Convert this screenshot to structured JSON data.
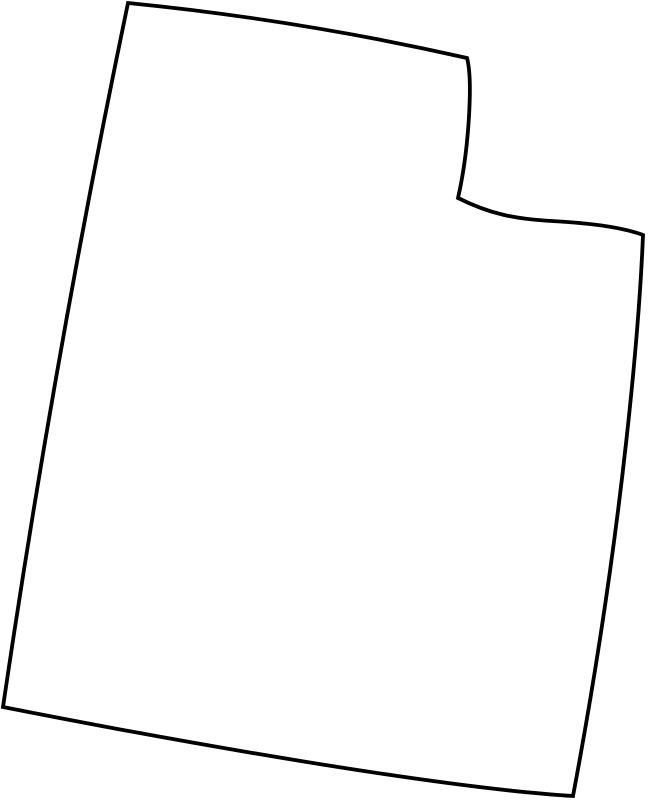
{
  "page": {
    "background_color": "#ffffff"
  },
  "map": {
    "region_name": "Utah",
    "kind": "blank-state-outline",
    "stroke_color": "#000000",
    "fill_color": "#ffffff",
    "stroke_width": "3.8",
    "outline_path": "M 128,3 Q 300,20 467,58 C 473,80 469,150 458,198 C 490,214 515,219 552,221 C 589,223 622,227 643,235 C 640,310 625,520 573,796 C 440,788 180,742 3,707 Q 55,353 128,3 Z"
  }
}
